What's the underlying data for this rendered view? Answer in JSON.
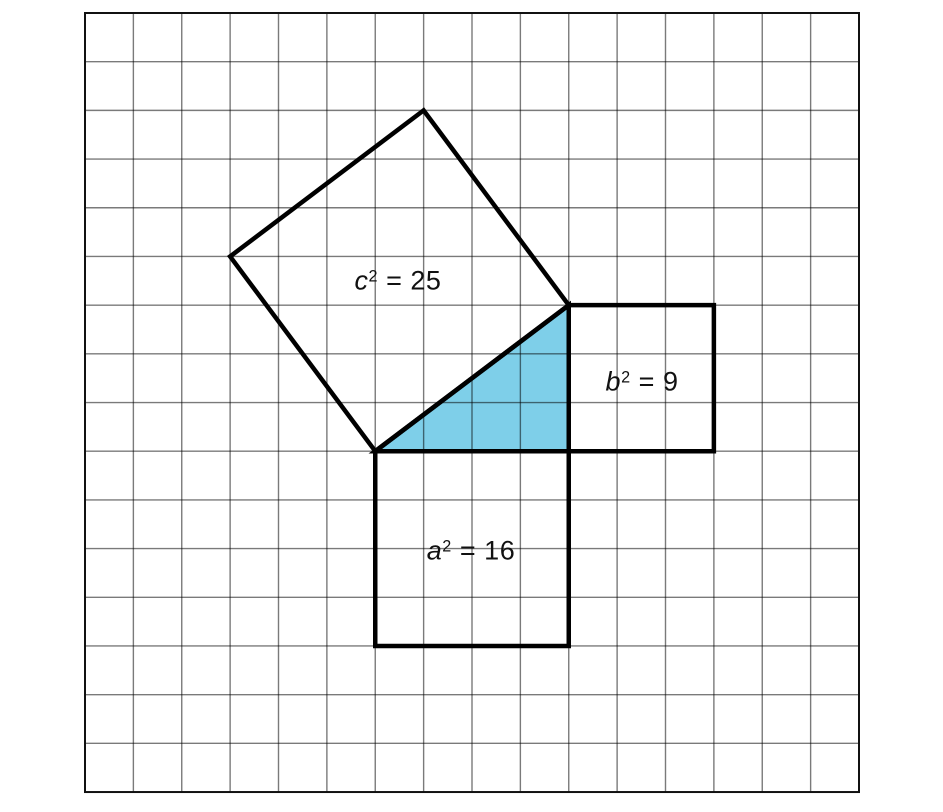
{
  "figure": {
    "background": "#ffffff",
    "grid": {
      "origin_x": 85,
      "origin_y": 13,
      "cols": 16,
      "rows": 16,
      "cell_w": 48.375,
      "cell_h": 48.69,
      "line_color": "rgba(0,0,0,0.52)",
      "line_width": 1.4,
      "border_color": "#111111",
      "border_width": 2
    },
    "shape_stroke_color": "#000000",
    "shape_stroke_width": 4.5,
    "triangle": {
      "name": "right-triangle",
      "fill": "#7ECFE9",
      "vertices_grid": [
        [
          6,
          9
        ],
        [
          10,
          9
        ],
        [
          10,
          6
        ]
      ]
    },
    "squares": [
      {
        "name": "c-square",
        "vertices_grid": [
          [
            6,
            9
          ],
          [
            3,
            5
          ],
          [
            7,
            2
          ],
          [
            10,
            6
          ]
        ]
      },
      {
        "name": "b-square",
        "vertices_grid": [
          [
            10,
            6
          ],
          [
            13,
            6
          ],
          [
            13,
            9
          ],
          [
            10,
            9
          ]
        ]
      },
      {
        "name": "a-square",
        "vertices_grid": [
          [
            6,
            9
          ],
          [
            10,
            9
          ],
          [
            10,
            13
          ],
          [
            6,
            13
          ]
        ]
      }
    ]
  },
  "labels": {
    "c": {
      "variable": "c",
      "exponent": "2",
      "equation": "= 25",
      "x": 398,
      "y": 281
    },
    "b": {
      "variable": "b",
      "exponent": "2",
      "equation": "= 9",
      "x": 642,
      "y": 382
    },
    "a": {
      "variable": "a",
      "exponent": "2",
      "equation": "= 16",
      "x": 471,
      "y": 551
    }
  }
}
